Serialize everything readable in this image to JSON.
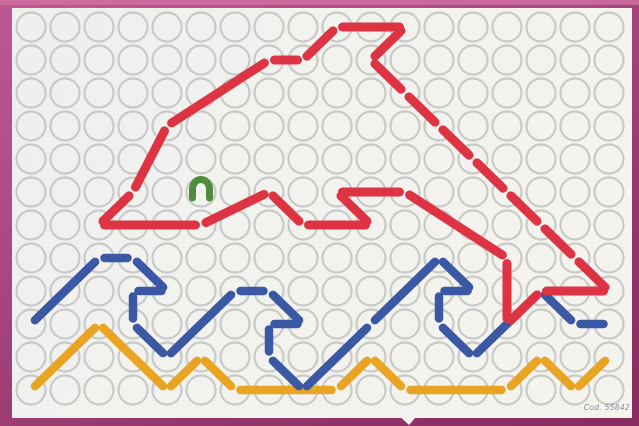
{
  "photo": {
    "background_main": "#a84780",
    "background_dark": "#872c5e",
    "top_strip": "#cf6f9f"
  },
  "board": {
    "x": 12,
    "y": 8,
    "width": 620,
    "height": 410,
    "bg": "#f2f2ef",
    "bg_edge": "#e9ebe9",
    "code_label": "Cod. 55842",
    "code_color": "#8f8498"
  },
  "grid": {
    "cols": 18,
    "rows": 12,
    "x0": 31,
    "y0": 27,
    "dx": 34,
    "dy": 33,
    "radius": 14.5,
    "ring_color": "#c8cac8",
    "ring_width": 2.2
  },
  "laces": [
    {
      "name": "wave-orange-lace",
      "color": "#e9a424",
      "width": 8.5,
      "gap": 5.5,
      "points": [
        [
          31,
          390
        ],
        [
          99,
          324
        ],
        [
          167,
          390
        ],
        [
          201,
          357
        ],
        [
          235,
          390
        ],
        [
          337,
          390
        ],
        [
          371,
          357
        ],
        [
          405,
          390
        ],
        [
          507,
          390
        ],
        [
          541,
          357
        ],
        [
          575,
          390
        ],
        [
          609,
          357
        ]
      ]
    },
    {
      "name": "waves-blue-lace",
      "color": "#3b58a5",
      "width": 8.5,
      "gap": 5.5,
      "points": [
        [
          31,
          324
        ],
        [
          99,
          258
        ],
        [
          133,
          258
        ],
        [
          167,
          291
        ],
        [
          133,
          291
        ],
        [
          133,
          324
        ],
        [
          167,
          357
        ],
        [
          235,
          291
        ],
        [
          269,
          291
        ],
        [
          303,
          324
        ],
        [
          269,
          324
        ],
        [
          269,
          357
        ],
        [
          303,
          390
        ],
        [
          371,
          324
        ],
        [
          439,
          258
        ],
        [
          473,
          291
        ],
        [
          439,
          291
        ],
        [
          439,
          324
        ],
        [
          473,
          357
        ],
        [
          541,
          291
        ],
        [
          575,
          324
        ],
        [
          609,
          324
        ]
      ]
    },
    {
      "name": "dolphin-outline-lace",
      "color": "#de3343",
      "width": 9,
      "gap": 5.5,
      "points": [
        [
          99,
          225
        ],
        [
          133,
          192
        ],
        [
          167,
          126
        ],
        [
          269,
          60
        ],
        [
          303,
          60
        ],
        [
          337,
          27
        ],
        [
          405,
          27
        ],
        [
          371,
          60
        ],
        [
          405,
          93
        ],
        [
          439,
          126
        ],
        [
          473,
          159
        ],
        [
          507,
          192
        ],
        [
          541,
          225
        ],
        [
          575,
          258
        ],
        [
          609,
          291
        ],
        [
          541,
          291
        ],
        [
          507,
          324
        ],
        [
          507,
          258
        ],
        [
          405,
          192
        ],
        [
          337,
          192
        ],
        [
          371,
          225
        ],
        [
          303,
          225
        ],
        [
          269,
          192
        ],
        [
          201,
          225
        ],
        [
          99,
          225
        ]
      ]
    }
  ],
  "eye": {
    "color": "#4f8c3e",
    "cx": 201,
    "cy": 189,
    "rx": 8.5,
    "ry": 9.5,
    "width": 7,
    "leg_y": 198
  },
  "notch": {
    "color": "#f5f4f2",
    "points": "393,410 422,410 409,425"
  }
}
